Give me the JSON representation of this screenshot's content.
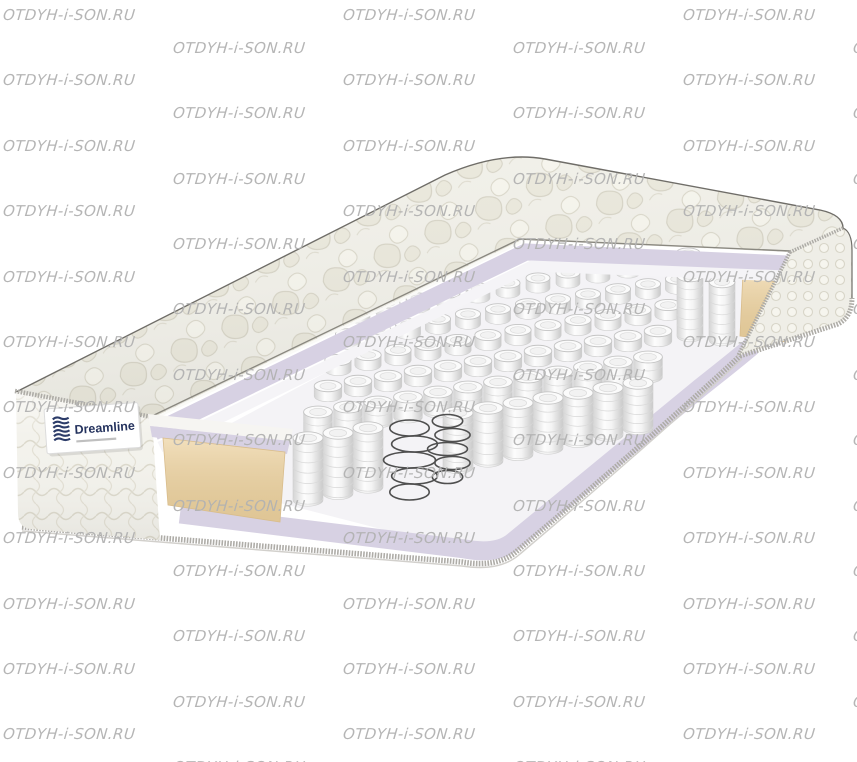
{
  "page": {
    "width": 857,
    "height": 762,
    "background": "#ffffff"
  },
  "watermark": {
    "text": "OTDYH-i-SON.RU",
    "color": "#b2b2b2"
  },
  "brand": {
    "name": "Dreamline",
    "name_color": "#25335e",
    "logo_icon": "brand-wave-lines-icon"
  },
  "mattress": {
    "view": "cutaway-3d-render",
    "parts": [
      "quilted-top-cover",
      "quilted-side-panel",
      "brand-label",
      "lavender-comfort-layer",
      "white-insulation-layer",
      "pocket-spring-block",
      "exposed-wire-coils",
      "beige-foam-side-wall",
      "lavender-base-layer",
      "braided-edge-piping"
    ],
    "colors": {
      "quilt": "#f1f0e9",
      "quilt_line": "#d5d2c4",
      "lavender": "#d7d1e3",
      "floor": "#f4f3f6",
      "beige": "#eed5a6",
      "piping": "#aeaca7",
      "outline": "#6f6d68",
      "spring": "#fbfbfb",
      "wire": "#4f4f4f"
    }
  }
}
